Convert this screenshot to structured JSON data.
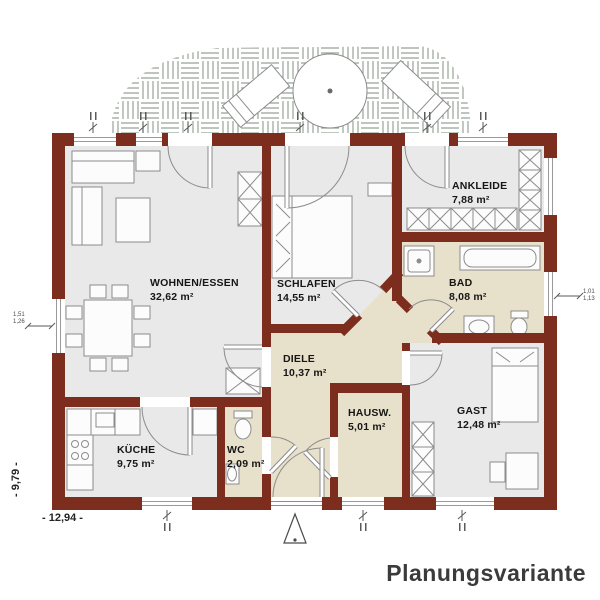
{
  "title": "Planungsvariante",
  "rooms": {
    "wohnen": {
      "name": "WOHNEN/ESSEN",
      "area": "32,62 m²"
    },
    "schlafen": {
      "name": "SCHLAFEN",
      "area": "14,55 m²"
    },
    "ankleide": {
      "name": "ANKLEIDE",
      "area": "7,88 m²"
    },
    "bad": {
      "name": "BAD",
      "area": "8,08 m²"
    },
    "diele": {
      "name": "DIELE",
      "area": "10,37 m²"
    },
    "hausw": {
      "name": "HAUSW.",
      "area": "5,01 m²"
    },
    "gast": {
      "name": "GAST",
      "area": "12,48 m²"
    },
    "kueche": {
      "name": "KÜCHE",
      "area": "9,75 m²"
    },
    "wc": {
      "name": "WC",
      "area": "2,09 m²"
    }
  },
  "dimensions": {
    "total_width": "- 12,94 -",
    "total_height": "- 9,79 -",
    "window_left": {
      "top": "1,51",
      "bottom": "1,26"
    },
    "window_right": {
      "top": "1,01",
      "bottom": "1,13"
    }
  },
  "colors": {
    "wall": "#7c2d1d",
    "room_gray": "#e9e9e9",
    "room_beige": "#e7e0ca",
    "terrace_hatch": "#97a197",
    "furniture_stroke": "#8c8c8c",
    "title_text": "#3b3b3b"
  }
}
